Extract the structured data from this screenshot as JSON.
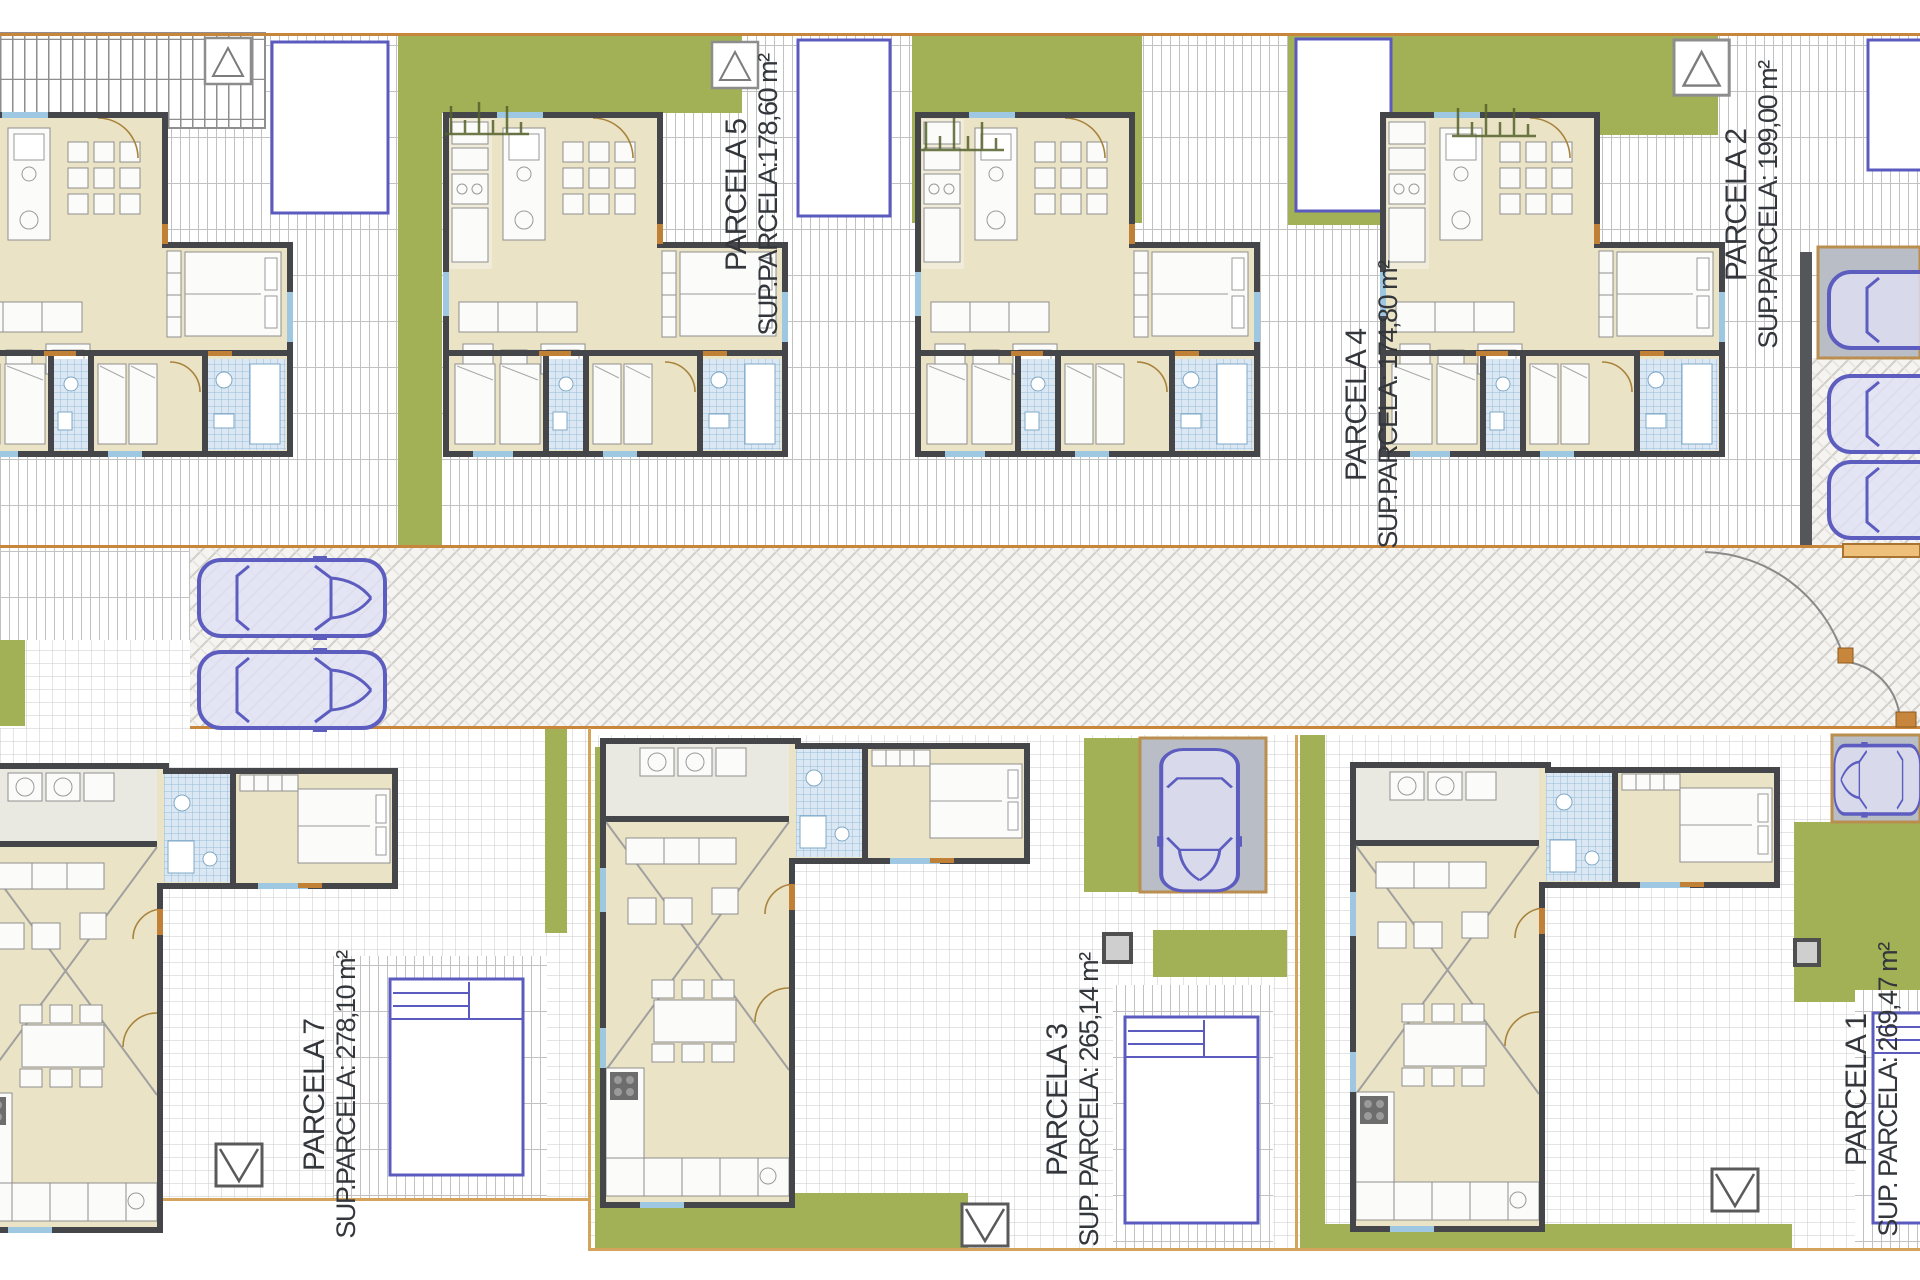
{
  "document": {
    "type": "residential-site-plan",
    "description": "Top-view site plan of a villa development with six labelled plots, floor plans, pools, gardens, road and parked cars"
  },
  "parcels": [
    {
      "id": "parcela-5",
      "name": "PARCELA 5",
      "sup": "SUP.PARCELA:178,60 m²"
    },
    {
      "id": "parcela-4",
      "name": "PARCELA 4",
      "sup": "SUP.PARCELA: 174,80 m²"
    },
    {
      "id": "parcela-2",
      "name": "PARCELA 2",
      "sup": "SUP.PARCELA: 199,00 m²"
    },
    {
      "id": "parcela-7",
      "name": "PARCELA 7",
      "sup": "SUP.PARCELA: 278,10 m²"
    },
    {
      "id": "parcela-3",
      "name": "PARCELA 3",
      "sup": "SUP. PARCELA: 265,14 m²"
    },
    {
      "id": "parcela-1",
      "name": "PARCELA 1",
      "sup": "SUP. PARCELA: 269,47 m²"
    }
  ],
  "vehicles": {
    "road_cars": 2,
    "right_edge_parked_cars": 3,
    "parcela_3_cars": 1,
    "parcela_1_cars": 1
  },
  "pools": {
    "top_row": 4,
    "bottom_row": 3
  },
  "colors": {
    "grass": "#a3b156",
    "pool_border": "#5b5bbf",
    "car_outline": "#5d5dc0",
    "boundary_orange": "#c8863c",
    "wall_dark": "#45464a",
    "interior_beige": "#ebe3c6",
    "carport_gray": "#b9bec6",
    "bath_tile_blue": "#dbe8f4",
    "tile_line": "#c9c9c9"
  },
  "icons": {
    "car": "car-icon",
    "pool": "swimming-pool-icon",
    "shed_roof": "shed-roof-icon",
    "shed_v": "shed-v-icon",
    "utility_box": "utility-box-icon",
    "pergola": "pergola-icon",
    "gate": "gate-icon"
  }
}
